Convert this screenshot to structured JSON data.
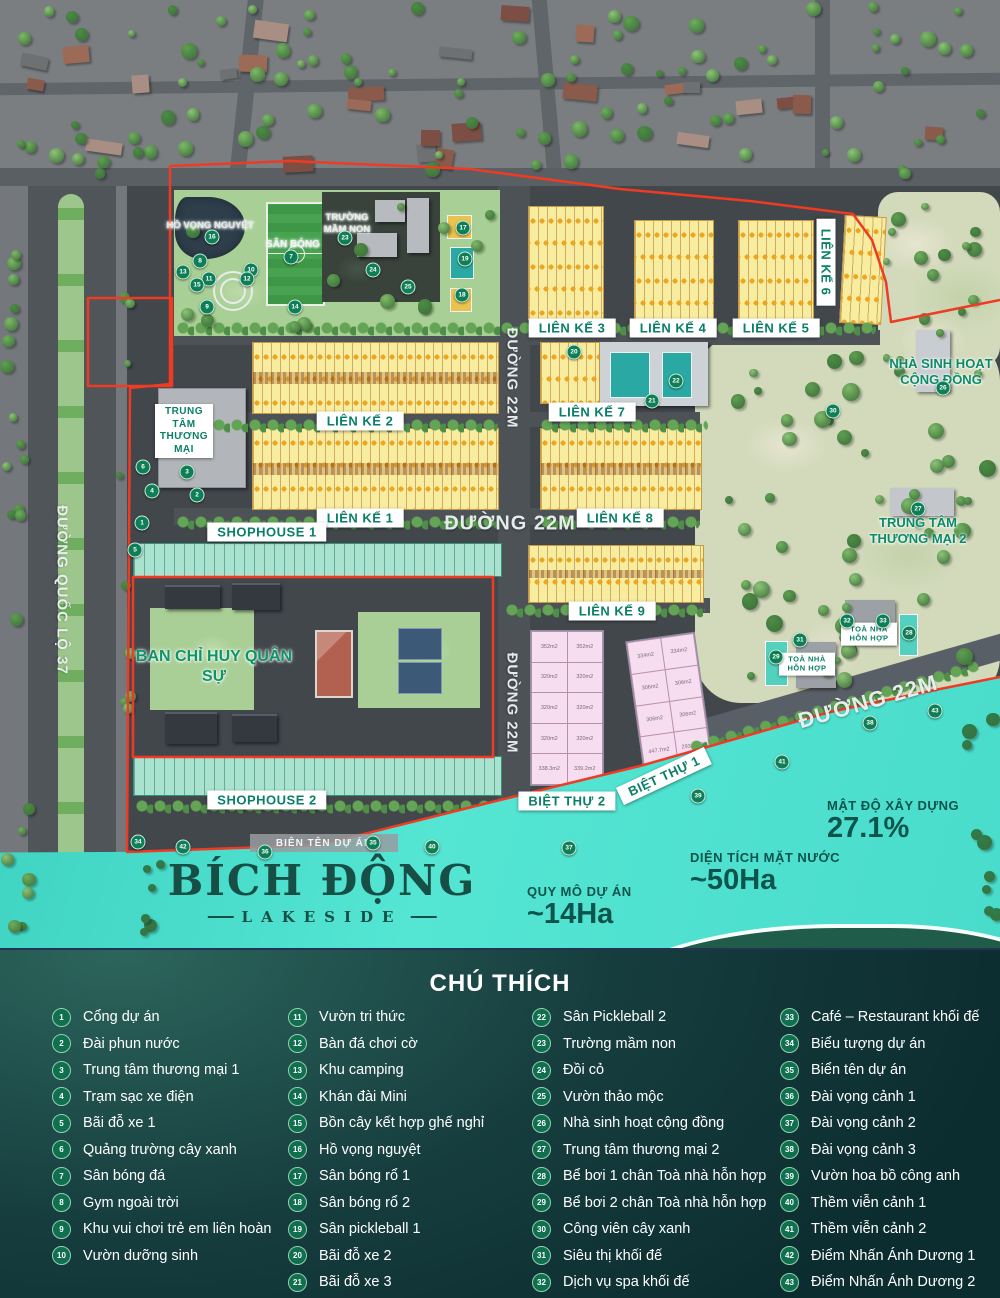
{
  "colors": {
    "boundary_red": "#ef3a24",
    "label_green": "#0a7f68",
    "water_teal": "#4fe0cf",
    "legend_bg_dark": "#0c2d30",
    "block_yellow": "#f8ec9e",
    "shophouse_teal": "#a9e2cf",
    "villa_pink": "#f6ddf0"
  },
  "map": {
    "zone_labels": [
      {
        "text": "LIÊN KẾ 3",
        "cx": 572,
        "cy": 328
      },
      {
        "text": "LIÊN KẾ 4",
        "cx": 673,
        "cy": 328
      },
      {
        "text": "LIÊN KẾ 5",
        "cx": 776,
        "cy": 328
      },
      {
        "text": "LIÊN KẾ 6",
        "cx": 826,
        "cy": 262,
        "rot": 90
      },
      {
        "text": "LIÊN KẾ 2",
        "cx": 360,
        "cy": 421
      },
      {
        "text": "LIÊN KẾ 7",
        "cx": 592,
        "cy": 412
      },
      {
        "text": "LIÊN KẾ 1",
        "cx": 360,
        "cy": 518
      },
      {
        "text": "LIÊN KẾ 8",
        "cx": 620,
        "cy": 518
      },
      {
        "text": "LIÊN KẾ 9",
        "cx": 612,
        "cy": 611
      },
      {
        "text": "SHOPHOUSE 1",
        "cx": 267,
        "cy": 532
      },
      {
        "text": "SHOPHOUSE 2",
        "cx": 267,
        "cy": 800
      },
      {
        "text": "BIỆT THỰ 2",
        "cx": 567,
        "cy": 801
      },
      {
        "text": "BIỆT THỰ 1",
        "cx": 664,
        "cy": 776,
        "rot": -25
      },
      {
        "text": "TOÀ NHÀ HỖN HỢP",
        "cx": 869,
        "cy": 634,
        "w": 48,
        "fs": 7.5
      },
      {
        "text": "TOÀ NHÀ HỖN HỢP",
        "cx": 807,
        "cy": 664,
        "w": 48,
        "fs": 7.5
      },
      {
        "text": "TRUNG TÂM THƯƠNG MẠI",
        "cx": 184,
        "cy": 431,
        "w": 50,
        "fs": 10
      }
    ],
    "glow_labels": [
      {
        "text": "HỒ VỌNG NGUYỆT",
        "cx": 210,
        "cy": 226,
        "color": "#dfe9e6",
        "fs": 9.5
      },
      {
        "text": "SÂN BÓNG",
        "cx": 293,
        "cy": 245,
        "color": "#eef4ef",
        "fs": 10
      },
      {
        "text": "TRƯỜNG MẦM NON",
        "cx": 347,
        "cy": 224,
        "color": "#e8eee9",
        "fs": 9.5,
        "w": 64
      },
      {
        "text": "NHÀ SINH HOẠT CỘNG ĐỒNG",
        "cx": 941,
        "cy": 372,
        "color": "#0b8a68",
        "fs": 13,
        "w": 140
      },
      {
        "text": "TRUNG TÂM THƯƠNG MẠI 2",
        "cx": 918,
        "cy": 531,
        "color": "#0b8a68",
        "fs": 13,
        "w": 140
      },
      {
        "text": "BAN CHỈ HUY QUÂN SỰ",
        "cx": 214,
        "cy": 667,
        "color": "#0f9468",
        "fs": 16,
        "w": 160
      }
    ],
    "road_labels": [
      {
        "text": "ĐƯỜNG QUỐC LỘ 37",
        "cx": 62,
        "cy": 590,
        "rot": 90,
        "fs": 15
      },
      {
        "text": "ĐƯỜNG 22M",
        "cx": 512,
        "cy": 378,
        "rot": 90,
        "fs": 15
      },
      {
        "text": "ĐƯỜNG 22M",
        "cx": 510,
        "cy": 524,
        "rot": 0,
        "fs": 20
      },
      {
        "text": "ĐƯỜNG 22M",
        "cx": 512,
        "cy": 703,
        "rot": 90,
        "fs": 15
      },
      {
        "text": "ĐƯỜNG 22M",
        "cx": 868,
        "cy": 702,
        "rot": -16,
        "fs": 22
      }
    ],
    "sign_bar": {
      "text": "BIÊN TÊN DỰ ÁN"
    },
    "logo": {
      "line1": "BÍCH ĐỘNG",
      "line2": "LAKESIDE"
    },
    "stats": [
      {
        "label": "QUY MÔ DỰ ÁN",
        "value": "~14Ha",
        "x": 527,
        "y": 884
      },
      {
        "label": "DIỆN TÍCH MẶT NƯỚC",
        "value": "~50Ha",
        "x": 690,
        "y": 850
      },
      {
        "label": "MẬT ĐỘ XÂY DỰNG",
        "value": "27.1%",
        "x": 827,
        "y": 798
      }
    ],
    "villa2_plots": [
      [
        "352m2",
        "352m2"
      ],
      [
        "320m2",
        "320m2"
      ],
      [
        "320m2",
        "320m2"
      ],
      [
        "320m2",
        "320m2"
      ],
      [
        "338.3m2",
        "339.2m2"
      ]
    ],
    "villa1_plots": [
      [
        "334m2",
        "334m2"
      ],
      [
        "306m2",
        "306m2"
      ],
      [
        "306m2",
        "306m2"
      ],
      [
        "447.7m2",
        "293.2m2"
      ]
    ],
    "markers": [
      {
        "n": 1,
        "x": 142,
        "y": 523
      },
      {
        "n": 2,
        "x": 197,
        "y": 495
      },
      {
        "n": 3,
        "x": 187,
        "y": 472
      },
      {
        "n": 4,
        "x": 152,
        "y": 491
      },
      {
        "n": 5,
        "x": 135,
        "y": 550
      },
      {
        "n": 6,
        "x": 143,
        "y": 467
      },
      {
        "n": 7,
        "x": 291,
        "y": 257
      },
      {
        "n": 8,
        "x": 200,
        "y": 261
      },
      {
        "n": 9,
        "x": 207,
        "y": 307
      },
      {
        "n": 10,
        "x": 251,
        "y": 270
      },
      {
        "n": 11,
        "x": 209,
        "y": 279
      },
      {
        "n": 12,
        "x": 247,
        "y": 279
      },
      {
        "n": 13,
        "x": 183,
        "y": 272
      },
      {
        "n": 14,
        "x": 295,
        "y": 307
      },
      {
        "n": 15,
        "x": 197,
        "y": 285
      },
      {
        "n": 16,
        "x": 212,
        "y": 237
      },
      {
        "n": 17,
        "x": 463,
        "y": 228
      },
      {
        "n": 18,
        "x": 462,
        "y": 295
      },
      {
        "n": 19,
        "x": 465,
        "y": 259
      },
      {
        "n": 20,
        "x": 574,
        "y": 352
      },
      {
        "n": 21,
        "x": 652,
        "y": 401
      },
      {
        "n": 22,
        "x": 676,
        "y": 381
      },
      {
        "n": 23,
        "x": 345,
        "y": 238
      },
      {
        "n": 24,
        "x": 373,
        "y": 270
      },
      {
        "n": 25,
        "x": 408,
        "y": 287
      },
      {
        "n": 26,
        "x": 943,
        "y": 388
      },
      {
        "n": 27,
        "x": 918,
        "y": 509
      },
      {
        "n": 28,
        "x": 909,
        "y": 633
      },
      {
        "n": 29,
        "x": 776,
        "y": 657
      },
      {
        "n": 30,
        "x": 833,
        "y": 411
      },
      {
        "n": 31,
        "x": 800,
        "y": 640
      },
      {
        "n": 32,
        "x": 847,
        "y": 621
      },
      {
        "n": 33,
        "x": 883,
        "y": 621
      },
      {
        "n": 34,
        "x": 138,
        "y": 842
      },
      {
        "n": 35,
        "x": 373,
        "y": 843
      },
      {
        "n": 36,
        "x": 265,
        "y": 852
      },
      {
        "n": 37,
        "x": 569,
        "y": 848
      },
      {
        "n": 38,
        "x": 870,
        "y": 723
      },
      {
        "n": 39,
        "x": 698,
        "y": 796
      },
      {
        "n": 40,
        "x": 432,
        "y": 847
      },
      {
        "n": 41,
        "x": 782,
        "y": 762
      },
      {
        "n": 42,
        "x": 183,
        "y": 847
      },
      {
        "n": 43,
        "x": 935,
        "y": 711
      }
    ]
  },
  "legend": {
    "title": "CHÚ THÍCH",
    "columns": [
      [
        {
          "n": 1,
          "label": "Cổng dự án"
        },
        {
          "n": 2,
          "label": "Đài phun nước"
        },
        {
          "n": 3,
          "label": "Trung tâm thương mại 1"
        },
        {
          "n": 4,
          "label": "Trạm sạc xe điện"
        },
        {
          "n": 5,
          "label": "Bãi đỗ xe 1"
        },
        {
          "n": 6,
          "label": "Quảng trường cây xanh"
        },
        {
          "n": 7,
          "label": "Sân bóng đá"
        },
        {
          "n": 8,
          "label": "Gym ngoài trời"
        },
        {
          "n": 9,
          "label": "Khu vui chơi trẻ em liên hoàn"
        },
        {
          "n": 10,
          "label": "Vườn dưỡng sinh"
        }
      ],
      [
        {
          "n": 11,
          "label": "Vườn tri thức"
        },
        {
          "n": 12,
          "label": "Bàn đá chơi cờ"
        },
        {
          "n": 13,
          "label": "Khu camping"
        },
        {
          "n": 14,
          "label": "Khán đài Mini"
        },
        {
          "n": 15,
          "label": "Bồn cây kết hợp ghế nghỉ"
        },
        {
          "n": 16,
          "label": "Hồ vọng nguyệt"
        },
        {
          "n": 17,
          "label": "Sân bóng rổ 1"
        },
        {
          "n": 18,
          "label": "Sân bóng rổ 2"
        },
        {
          "n": 19,
          "label": "Sân pickleball 1"
        },
        {
          "n": 20,
          "label": "Bãi đỗ xe 2"
        },
        {
          "n": 21,
          "label": "Bãi đỗ xe 3"
        }
      ],
      [
        {
          "n": 22,
          "label": "Sân Pickleball 2"
        },
        {
          "n": 23,
          "label": "Trường mầm non"
        },
        {
          "n": 24,
          "label": "Đồi cỏ"
        },
        {
          "n": 25,
          "label": "Vườn thảo mộc"
        },
        {
          "n": 26,
          "label": "Nhà sinh hoạt cộng đồng"
        },
        {
          "n": 27,
          "label": "Trung tâm thương mại 2"
        },
        {
          "n": 28,
          "label": "Bể bơi 1 chân Toà nhà hỗn hợp"
        },
        {
          "n": 29,
          "label": "Bể bơi 2 chân Toà nhà hỗn hợp"
        },
        {
          "n": 30,
          "label": "Công viên cây xanh"
        },
        {
          "n": 31,
          "label": "Siêu thị khối đế"
        },
        {
          "n": 32,
          "label": "Dịch vụ spa khối đế"
        }
      ],
      [
        {
          "n": 33,
          "label": "Café – Restaurant khối đế"
        },
        {
          "n": 34,
          "label": "Biểu tượng dự án"
        },
        {
          "n": 35,
          "label": "Biển tên dự án"
        },
        {
          "n": 36,
          "label": "Đài vọng cảnh 1"
        },
        {
          "n": 37,
          "label": "Đài vọng cảnh 2"
        },
        {
          "n": 38,
          "label": "Đài vọng cảnh 3"
        },
        {
          "n": 39,
          "label": "Vườn hoa bồ công anh"
        },
        {
          "n": 40,
          "label": "Thềm viễn cảnh 1"
        },
        {
          "n": 41,
          "label": "Thềm viễn cảnh 2"
        },
        {
          "n": 42,
          "label": "Điểm Nhấn Ánh Dương 1"
        },
        {
          "n": 43,
          "label": "Điểm Nhấn Ánh Dương 2"
        }
      ]
    ]
  }
}
